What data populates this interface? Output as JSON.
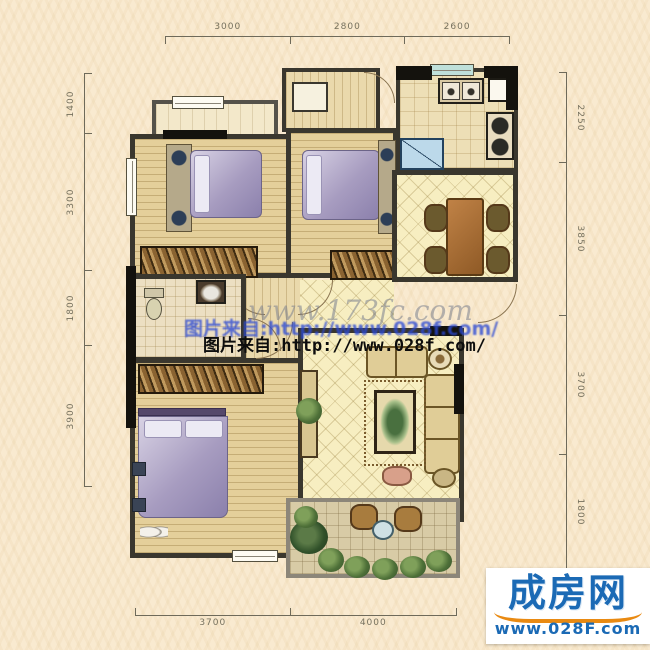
{
  "dimensions": {
    "top": [
      "3000",
      "2800",
      "2600"
    ],
    "bottom": [
      "3700",
      "4000"
    ],
    "left": [
      "1400",
      "3300",
      "1800",
      "3900"
    ],
    "right": [
      "2250",
      "3850",
      "3700",
      "1800"
    ]
  },
  "watermarks": {
    "site_script": "www.173fc.com",
    "line_blue": "图片来自:http://www.028f.com/",
    "line_black": "图片来自:http://www.028f.com/"
  },
  "logo": {
    "name": "成房网",
    "url": "www.028F.com"
  },
  "colors": {
    "background": "#f9ead0",
    "wall": "#3a372e",
    "wall_black": "#14120d",
    "wood_floor": "#e4cf9a",
    "lattice_floor": "#f7eec1",
    "watermark_blue": "#2b49d4",
    "logo_blue": "#1b6ab5",
    "logo_orange": "#e98a12"
  }
}
